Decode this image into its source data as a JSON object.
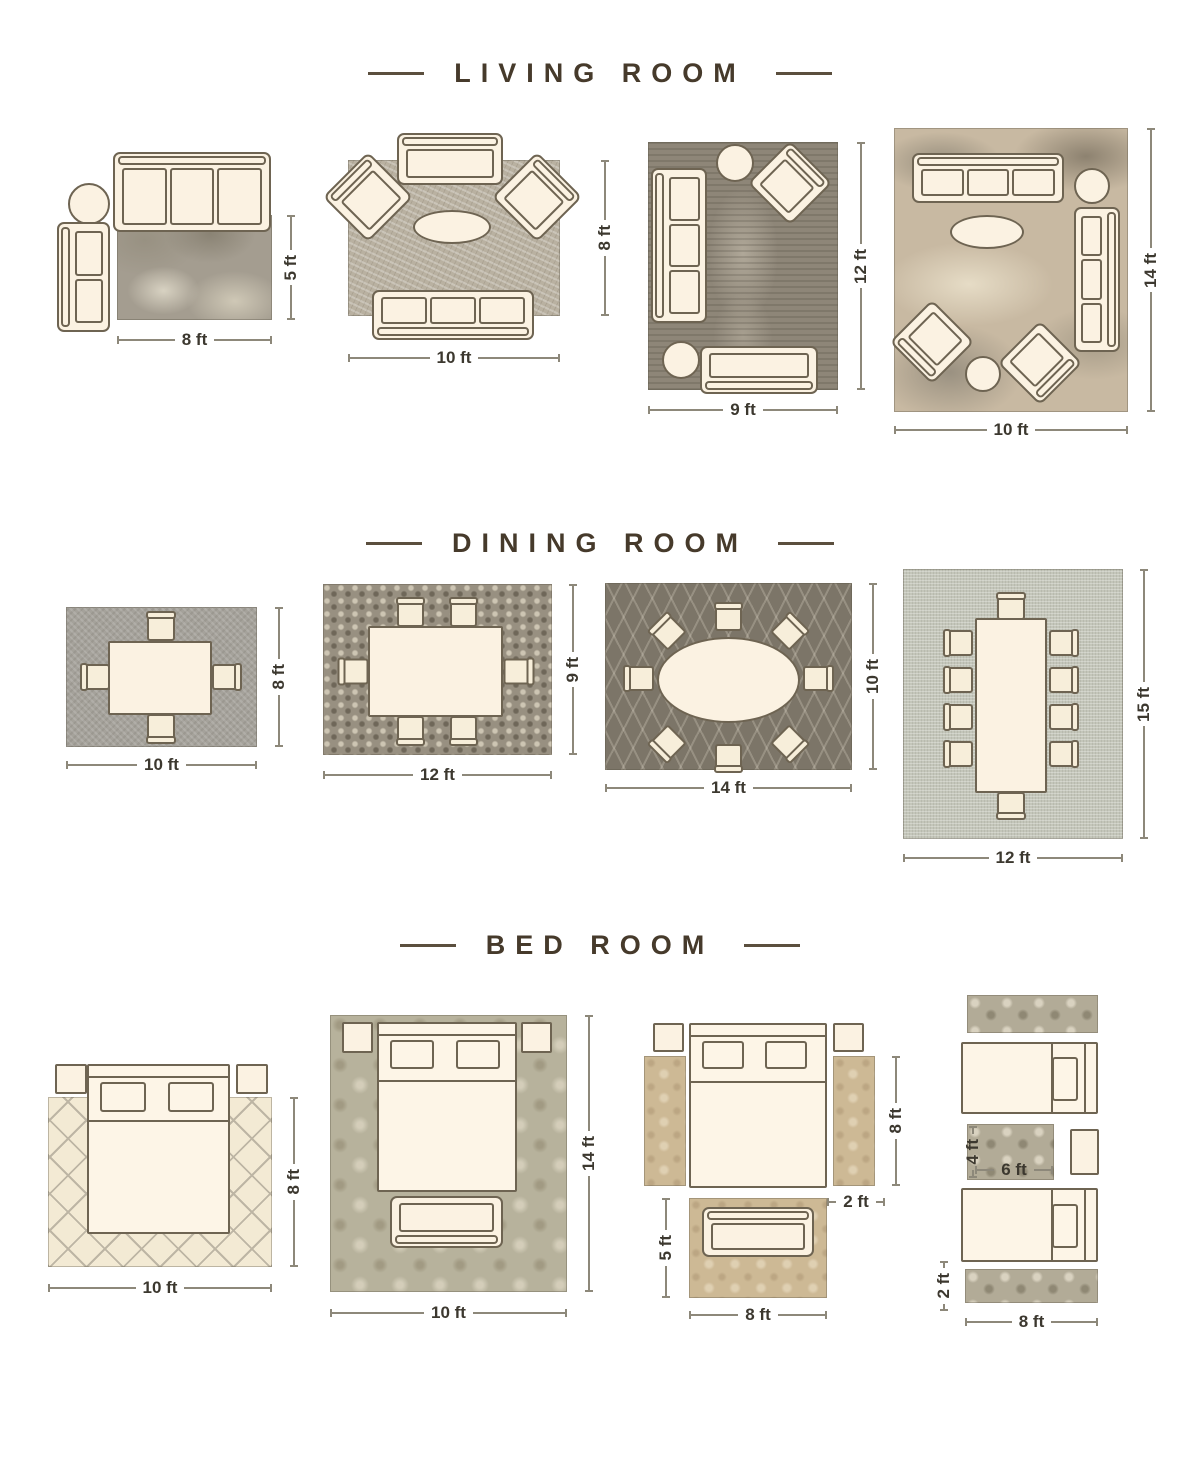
{
  "page_title": "Rug Size Guide",
  "colors": {
    "background": "#ffffff",
    "title_text": "#463a2b",
    "dimension_text": "#3c382f",
    "dimension_line": "#8d887a",
    "furniture_fill": "#fbf2e2",
    "furniture_outline": "#6e6452"
  },
  "sections": [
    {
      "id": "living-room",
      "title": "LIVING ROOM",
      "layouts": [
        {
          "id": "living-8x5",
          "rug_size": "8 ft x 5 ft",
          "rug_style": "distressed gray",
          "furniture": [
            "three-seat-sofa",
            "round-side-table",
            "chaise-sofa"
          ],
          "labels": {
            "width": "8 ft",
            "height": "5 ft"
          }
        },
        {
          "id": "living-10x8",
          "rug_size": "10 ft x 8 ft",
          "rug_style": "textured greige",
          "furniture": [
            "loveseat",
            "armchair",
            "armchair",
            "oval-coffee-table",
            "three-seat-sofa"
          ],
          "labels": {
            "width": "10 ft",
            "height": "8 ft"
          }
        },
        {
          "id": "living-9x12",
          "rug_size": "9 ft x 12 ft",
          "rug_style": "vintage distressed brown",
          "furniture": [
            "round-side-table",
            "armchair",
            "three-seat-sofa",
            "round-side-table",
            "loveseat"
          ],
          "labels": {
            "width": "9 ft",
            "height": "12 ft"
          }
        },
        {
          "id": "living-10x14",
          "rug_size": "10 ft x 14 ft",
          "rug_style": "abstract beige-gray",
          "furniture": [
            "three-seat-sofa",
            "round-side-table",
            "oval-coffee-table",
            "three-seat-sofa",
            "armchair",
            "armchair",
            "round-side-table"
          ],
          "labels": {
            "width": "10 ft",
            "height": "14 ft"
          }
        }
      ]
    },
    {
      "id": "dining-room",
      "title": "DINING ROOM",
      "layouts": [
        {
          "id": "dining-10x8",
          "rug_size": "10 ft x 8 ft",
          "rug_style": "woven gray",
          "furniture": [
            "dining-table",
            "4-chairs"
          ],
          "labels": {
            "width": "10 ft",
            "height": "8 ft"
          }
        },
        {
          "id": "dining-12x9",
          "rug_size": "12 ft x 9 ft",
          "rug_style": "mosaic pebble",
          "furniture": [
            "dining-table",
            "6-chairs"
          ],
          "labels": {
            "width": "12 ft",
            "height": "9 ft"
          }
        },
        {
          "id": "dining-14x10",
          "rug_size": "14 ft x 10 ft",
          "rug_style": "dark gray trellis",
          "furniture": [
            "oval-dining-table",
            "8-chairs"
          ],
          "labels": {
            "width": "14 ft",
            "height": "10 ft"
          }
        },
        {
          "id": "dining-12x15",
          "rug_size": "12 ft x 15 ft",
          "rug_style": "light woven",
          "furniture": [
            "long-dining-table",
            "10-chairs"
          ],
          "labels": {
            "width": "12 ft",
            "height": "15 ft"
          }
        }
      ]
    },
    {
      "id": "bed-room",
      "title": "BED ROOM",
      "layouts": [
        {
          "id": "bed-10x8",
          "rug_size": "10 ft x 8 ft",
          "rug_style": "cream trellis",
          "furniture": [
            "queen-bed",
            "nightstand",
            "nightstand"
          ],
          "labels": {
            "width": "10 ft",
            "height": "8 ft"
          }
        },
        {
          "id": "bed-10x14",
          "rug_size": "10 ft x 14 ft",
          "rug_style": "damask sage",
          "furniture": [
            "queen-bed",
            "nightstand",
            "nightstand",
            "bench"
          ],
          "labels": {
            "width": "10 ft",
            "height": "14 ft"
          }
        },
        {
          "id": "bed-runners-8x2-and-8x5",
          "rug_size": "two 8 ft x 2 ft runners + 8 ft x 5 ft",
          "rug_style": "vintage tan floral",
          "furniture": [
            "queen-bed",
            "nightstand",
            "nightstand",
            "loveseat"
          ],
          "labels": {
            "runner_length": "8 ft",
            "runner_width": "2 ft",
            "foot_rug_height": "5 ft",
            "foot_rug_width": "8 ft"
          }
        },
        {
          "id": "bed-twins-8x2-and-6x4",
          "rug_size": "two 8 ft x 2 ft runners + 6 ft x 4 ft",
          "rug_style": "ornate taupe",
          "furniture": [
            "twin-bed",
            "twin-bed",
            "nightstand"
          ],
          "labels": {
            "accent_rug_height": "4 ft",
            "accent_rug_width": "6 ft",
            "runner_width": "2 ft",
            "runner_length": "8 ft"
          }
        }
      ]
    }
  ]
}
